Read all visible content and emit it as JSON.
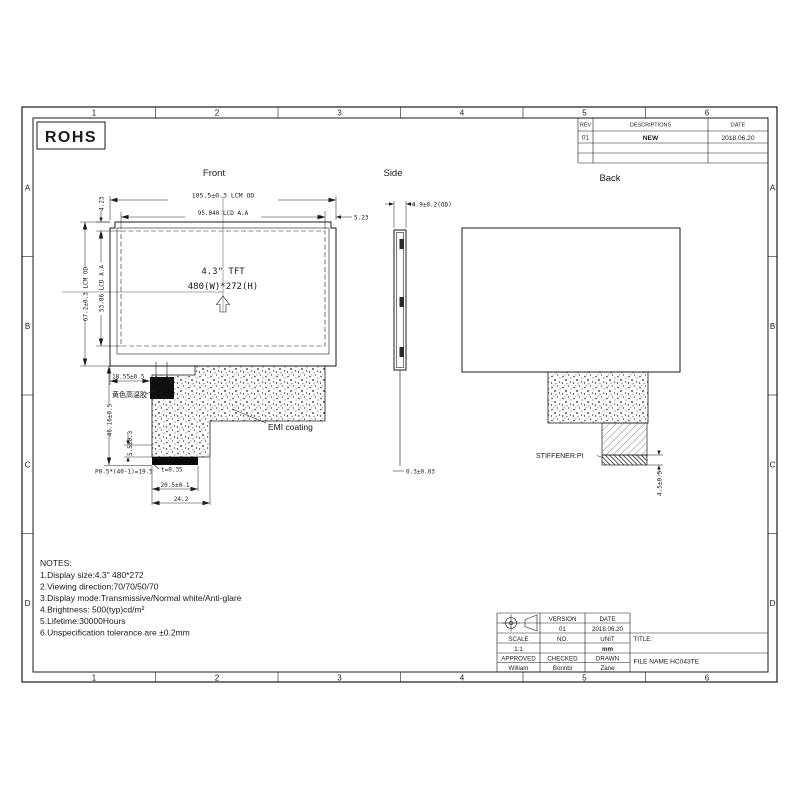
{
  "rohs": "ROHS",
  "grid": {
    "columns": [
      "1",
      "2",
      "3",
      "4",
      "5",
      "6"
    ],
    "rows": [
      "A",
      "B",
      "C",
      "D"
    ]
  },
  "revision_table": {
    "rev_header": "REV",
    "descriptions_header": "DESCRIPTIONS",
    "date_header": "DATE",
    "rows": [
      {
        "rev": "01",
        "description": "NEW",
        "date": "2018.06.20"
      }
    ]
  },
  "front": {
    "label": "Front",
    "dim_lcm_width": "105.5±0.3 LCM OD",
    "dim_aa_width": "95.040 LCD A.A",
    "dim_right_margin": "5.23",
    "dim_top_margin": "4.23",
    "dim_lcm_height": "67.2±0.3 LCM OD",
    "dim_aa_height": "53.86 LCD A.A",
    "screen_line1": "4.3\" TFT",
    "screen_line2": "480(W)*272(H)",
    "dim_tape": "18.55±0.5",
    "tape_label": "黄色高温胶",
    "dim_fpc_length": "46.16±0.5",
    "dim_step": "5.5±0.3",
    "emi_label": "EMI coating",
    "dim_thickness": "t=0.35",
    "dim_pitch": "P0.5*(40-1)=19.5",
    "dim_finger_width": "20.5±0.1",
    "dim_fpc_width": "24.2"
  },
  "side": {
    "label": "Side",
    "dim_thickness": "4.9±0.2(OD)",
    "dim_fpc_thickness": "0.3±0.03"
  },
  "back": {
    "label": "Back",
    "stiffener_label": "STIFFENER:PI",
    "dim_stiffener": "4.5±0.5"
  },
  "notes": {
    "title": "NOTES:",
    "items": [
      "1.Display size:4.3\" 480*272",
      "2.Viewing direction:70/70/50/70",
      "3.Display mode:Transmissive/Normal white/Anti-glare",
      "4.Brightness: 500(typ)cd/m²",
      "5.Lifetime:30000Hours",
      "6.Unspecification tolerance are ±0.2mm"
    ]
  },
  "title_block": {
    "version_label": "VERSION",
    "date_label": "DATE",
    "version": "01",
    "date": "2018.06.20",
    "scale_label": "SCALE",
    "no_label": "NO.",
    "unit_label": "UNIT",
    "scale": "1:1",
    "unit": "mm",
    "approved_label": "APPROVED",
    "checked_label": "CHECKED",
    "drawn_label": "DRAWN",
    "approved": "William",
    "checked": "Bonnbi",
    "drawn": "Zane",
    "title_label": "TITLE:",
    "file_name": "FILE NAME:HC043TE"
  },
  "colors": {
    "line": "#1a1a1a",
    "paper": "#ffffff"
  }
}
